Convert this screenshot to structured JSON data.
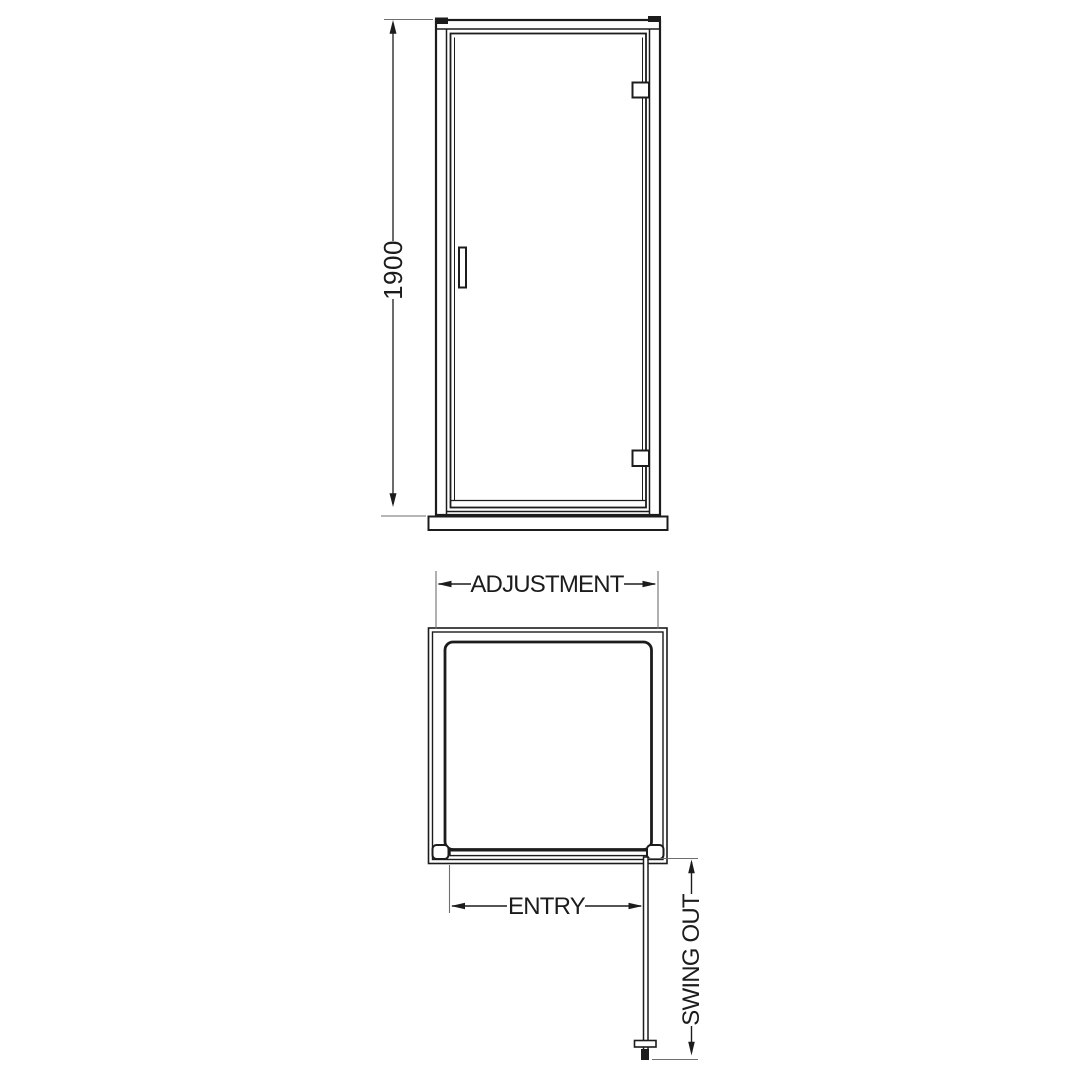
{
  "colors": {
    "background": "#ffffff",
    "line": "#1c1c1c",
    "extension_line": "#6e6e6e"
  },
  "front_view": {
    "height_dimension": {
      "label": "1900"
    }
  },
  "plan_view": {
    "adjustment_dimension": {
      "label": "ADJUSTMENT"
    },
    "entry_dimension": {
      "label": "ENTRY"
    },
    "swing_dimension": {
      "label": "SWING OUT"
    }
  }
}
